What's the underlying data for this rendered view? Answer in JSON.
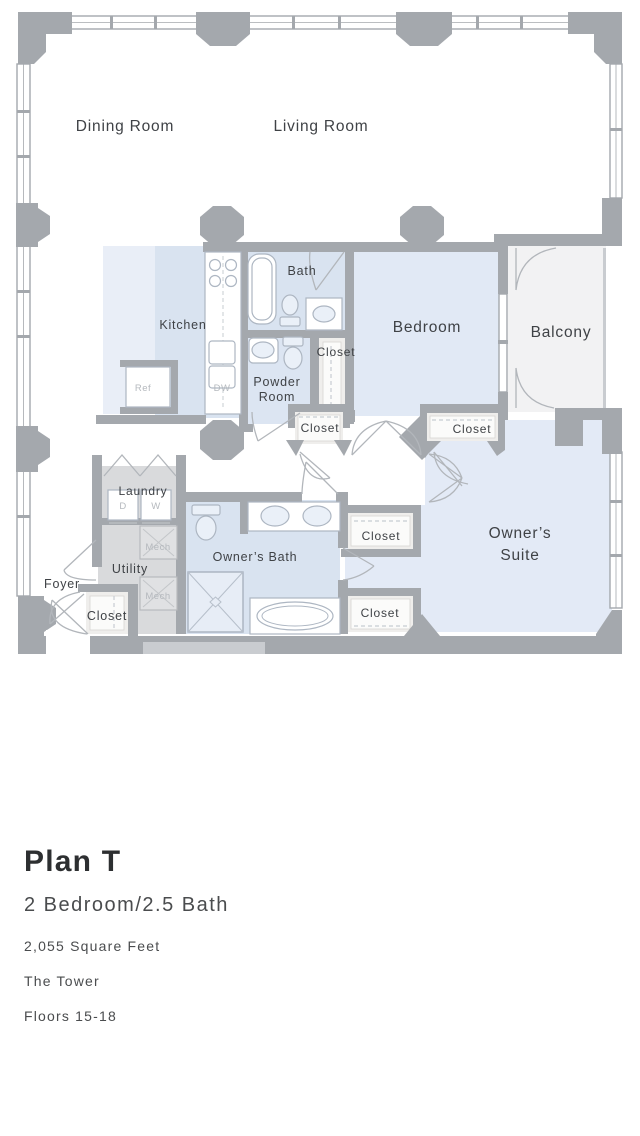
{
  "plan": {
    "labels": {
      "dining_room": "Dining Room",
      "living_room": "Living Room",
      "kitchen": "Kitchen",
      "bath": "Bath",
      "bedroom": "Bedroom",
      "balcony": "Balcony",
      "powder_line1": "Powder",
      "powder_line2": "Room",
      "closet": "Closet",
      "laundry": "Laundry",
      "dryer": "D",
      "washer": "W",
      "mech": "Mech",
      "utility": "Utility",
      "foyer": "Foyer",
      "owners_bath": "Owner’s Bath",
      "owners_suite_line1": "Owner’s",
      "owners_suite_line2": "Suite",
      "ref": "Ref",
      "dw": "DW"
    },
    "colors": {
      "wall_gray": "#a4a8ad",
      "room_blue": "#e1e9f5",
      "room_blue_dark": "#d9e3f0",
      "room_blue_pale": "#e9eef7",
      "balcony_gray": "#f2f2f3",
      "utility_gray": "#d9dadc",
      "label_dark": "#3f4246",
      "label_faint": "#b5b9be"
    }
  },
  "caption": {
    "title": "Plan T",
    "subtitle": "2 Bedroom/2.5 Bath",
    "area": "2,055 Square Feet",
    "building": "The Tower",
    "floors": "Floors 15-18"
  }
}
